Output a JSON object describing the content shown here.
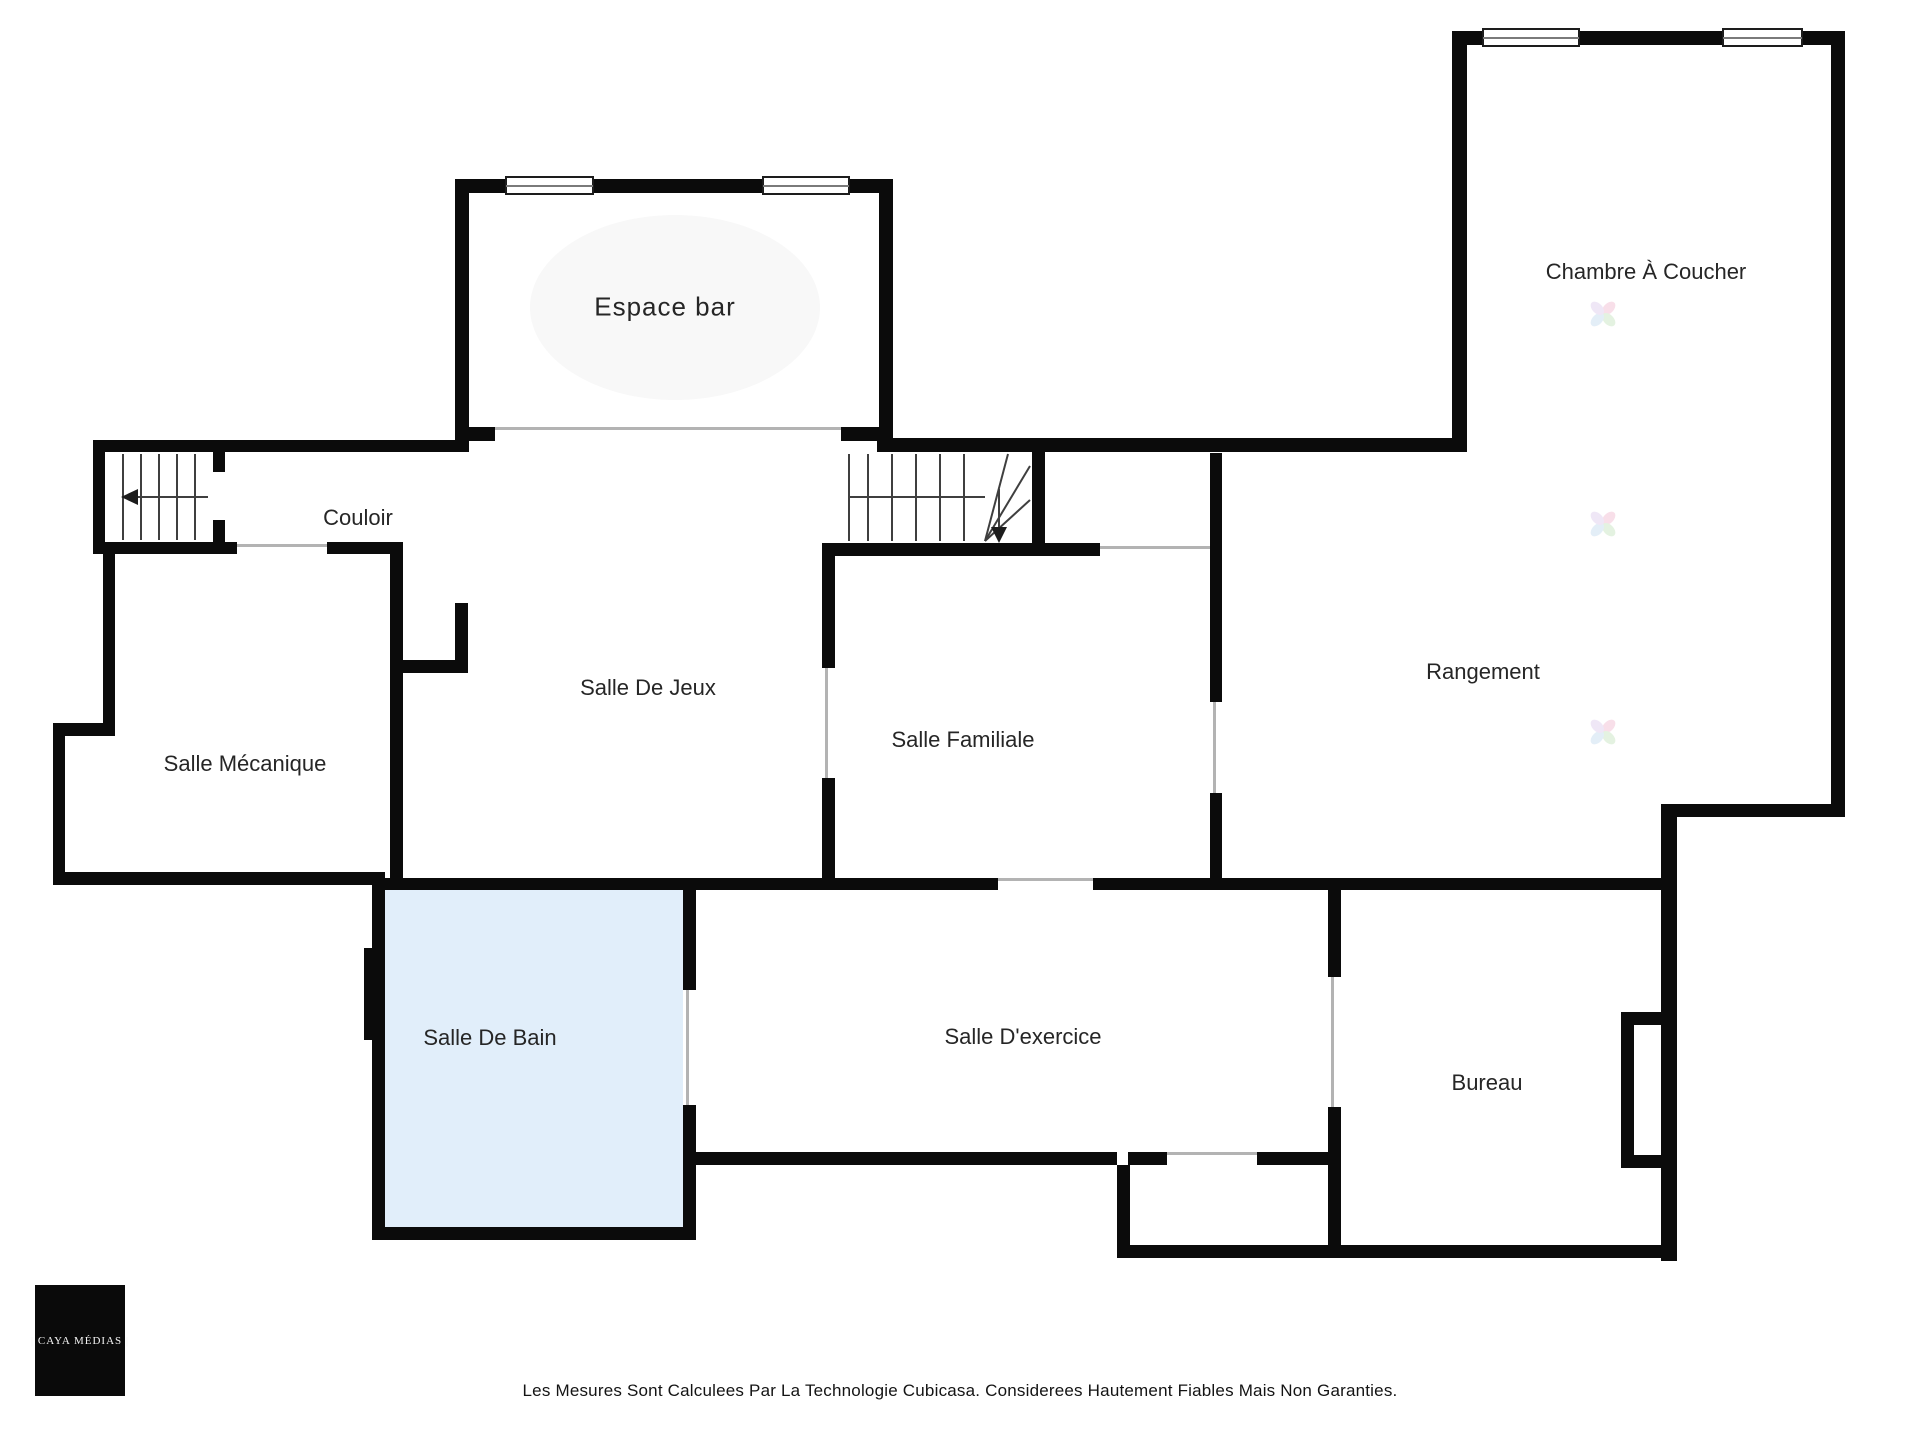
{
  "meta": {
    "footer": "Les Mesures Sont Calculees Par La Technologie Cubicasa. Considerees Hautement Fiables Mais Non Garanties.",
    "logo_text": "| CAYA MÉDIAS |"
  },
  "colors": {
    "wall": "#0b0b0b",
    "door_line": "#b3b3b3",
    "bath_fill": "#e1eefa",
    "label": "#262626",
    "stair_stroke": "#3f3f3f"
  },
  "rooms": [
    {
      "name": "espace-bar",
      "label": "Espace bar",
      "x": 665,
      "y": 307,
      "size": 26,
      "ls": 1
    },
    {
      "name": "chambre-a-coucher",
      "label": "Chambre À Coucher",
      "x": 1646,
      "y": 272,
      "size": 22,
      "ls": 0
    },
    {
      "name": "couloir",
      "label": "Couloir",
      "x": 358,
      "y": 518,
      "size": 22,
      "ls": 0
    },
    {
      "name": "salle-de-jeux",
      "label": "Salle De Jeux",
      "x": 648,
      "y": 688,
      "size": 22,
      "ls": 0
    },
    {
      "name": "salle-mecanique",
      "label": "Salle Mécanique",
      "x": 245,
      "y": 764,
      "size": 22,
      "ls": 0
    },
    {
      "name": "salle-familiale",
      "label": "Salle Familiale",
      "x": 963,
      "y": 740,
      "size": 22,
      "ls": 0
    },
    {
      "name": "rangement",
      "label": "Rangement",
      "x": 1483,
      "y": 672,
      "size": 22,
      "ls": 0
    },
    {
      "name": "salle-de-bain",
      "label": "Salle De Bain",
      "x": 490,
      "y": 1038,
      "size": 22,
      "ls": 0
    },
    {
      "name": "salle-dexercice",
      "label": "Salle D'exercice",
      "x": 1023,
      "y": 1037,
      "size": 22,
      "ls": 0
    },
    {
      "name": "bureau",
      "label": "Bureau",
      "x": 1487,
      "y": 1083,
      "size": 22,
      "ls": 0
    }
  ],
  "geometry": {
    "fills": [
      {
        "x": 385,
        "y": 890,
        "w": 298,
        "h": 337,
        "color": "#e1eefa",
        "round": false
      },
      {
        "x": 530,
        "y": 215,
        "w": 290,
        "h": 185,
        "color": "#f8f8f8",
        "round": true
      }
    ],
    "walls": [
      [
        455,
        179,
        14,
        273
      ],
      [
        455,
        179,
        438,
        14
      ],
      [
        879,
        179,
        14,
        273
      ],
      [
        455,
        427,
        40,
        14
      ],
      [
        841,
        427,
        52,
        14
      ],
      [
        93,
        440,
        375,
        12
      ],
      [
        877,
        438,
        590,
        14
      ],
      [
        1452,
        31,
        15,
        421
      ],
      [
        1452,
        31,
        393,
        14
      ],
      [
        1831,
        31,
        14,
        786
      ],
      [
        1677,
        804,
        168,
        13
      ],
      [
        1661,
        804,
        16,
        457
      ],
      [
        1117,
        1245,
        560,
        13
      ],
      [
        93,
        452,
        12,
        102
      ],
      [
        93,
        542,
        132,
        12
      ],
      [
        213,
        452,
        12,
        20
      ],
      [
        213,
        520,
        12,
        34
      ],
      [
        225,
        542,
        12,
        12
      ],
      [
        327,
        542,
        76,
        12
      ],
      [
        390,
        542,
        13,
        348
      ],
      [
        390,
        660,
        78,
        13
      ],
      [
        455,
        603,
        13,
        70
      ],
      [
        103,
        554,
        12,
        182
      ],
      [
        53,
        723,
        62,
        13
      ],
      [
        53,
        736,
        12,
        149
      ],
      [
        53,
        872,
        332,
        13
      ],
      [
        372,
        878,
        13,
        362
      ],
      [
        364,
        948,
        19,
        92
      ],
      [
        372,
        1227,
        324,
        13
      ],
      [
        683,
        890,
        13,
        100
      ],
      [
        683,
        1105,
        13,
        122
      ],
      [
        372,
        878,
        626,
        12
      ],
      [
        1093,
        878,
        568,
        12
      ],
      [
        822,
        543,
        278,
        13
      ],
      [
        1032,
        452,
        13,
        91
      ],
      [
        822,
        556,
        13,
        112
      ],
      [
        822,
        778,
        13,
        112
      ],
      [
        1210,
        453,
        12,
        249
      ],
      [
        1210,
        793,
        12,
        85
      ],
      [
        1328,
        890,
        13,
        87
      ],
      [
        1328,
        1107,
        13,
        138
      ],
      [
        1117,
        1165,
        13,
        92
      ],
      [
        1128,
        1152,
        39,
        13
      ],
      [
        1257,
        1152,
        71,
        13
      ],
      [
        696,
        1152,
        421,
        13
      ],
      [
        1621,
        1012,
        13,
        156
      ],
      [
        1634,
        1012,
        30,
        13
      ],
      [
        1634,
        1155,
        30,
        13
      ]
    ],
    "door_lines": [
      [
        495,
        427,
        346,
        3
      ],
      [
        95,
        462,
        3,
        72
      ],
      [
        237,
        544,
        90,
        3
      ],
      [
        1100,
        546,
        110,
        3
      ],
      [
        825,
        668,
        3,
        110
      ],
      [
        1213,
        702,
        3,
        91
      ],
      [
        998,
        878,
        95,
        3
      ],
      [
        686,
        990,
        3,
        115
      ],
      [
        1331,
        977,
        3,
        130
      ],
      [
        1167,
        1152,
        92,
        3
      ]
    ],
    "windows": [
      {
        "x": 505,
        "y": 176,
        "w": 89,
        "h": 19
      },
      {
        "x": 762,
        "y": 176,
        "w": 88,
        "h": 19
      },
      {
        "x": 1482,
        "y": 28,
        "w": 98,
        "h": 19
      },
      {
        "x": 1722,
        "y": 28,
        "w": 81,
        "h": 19
      }
    ],
    "stair_lines": [
      [
        123,
        454,
        123,
        540
      ],
      [
        141,
        454,
        141,
        540
      ],
      [
        159,
        454,
        159,
        540
      ],
      [
        177,
        454,
        177,
        540
      ],
      [
        195,
        454,
        195,
        540
      ],
      [
        138,
        497,
        208,
        497
      ],
      [
        849,
        454,
        849,
        541
      ],
      [
        868,
        454,
        868,
        541
      ],
      [
        892,
        454,
        892,
        541
      ],
      [
        916,
        454,
        916,
        541
      ],
      [
        940,
        454,
        940,
        541
      ],
      [
        964,
        454,
        964,
        541
      ],
      [
        849,
        497,
        985,
        497
      ],
      [
        985,
        541,
        1008,
        454
      ],
      [
        985,
        541,
        1030,
        466
      ],
      [
        985,
        541,
        1030,
        500
      ],
      [
        999,
        489,
        999,
        529
      ]
    ],
    "arrows": [
      {
        "points": "121,497 138,489 138,505"
      },
      {
        "points": "991,527 1007,527 999,543"
      }
    ],
    "watermarks": [
      {
        "x": 1585,
        "y": 296
      },
      {
        "x": 1585,
        "y": 506
      },
      {
        "x": 1585,
        "y": 714
      }
    ],
    "watermark_petals": [
      "#f3c6d8",
      "#cfe8c9",
      "#cde1f2",
      "#e2d4ef"
    ]
  }
}
